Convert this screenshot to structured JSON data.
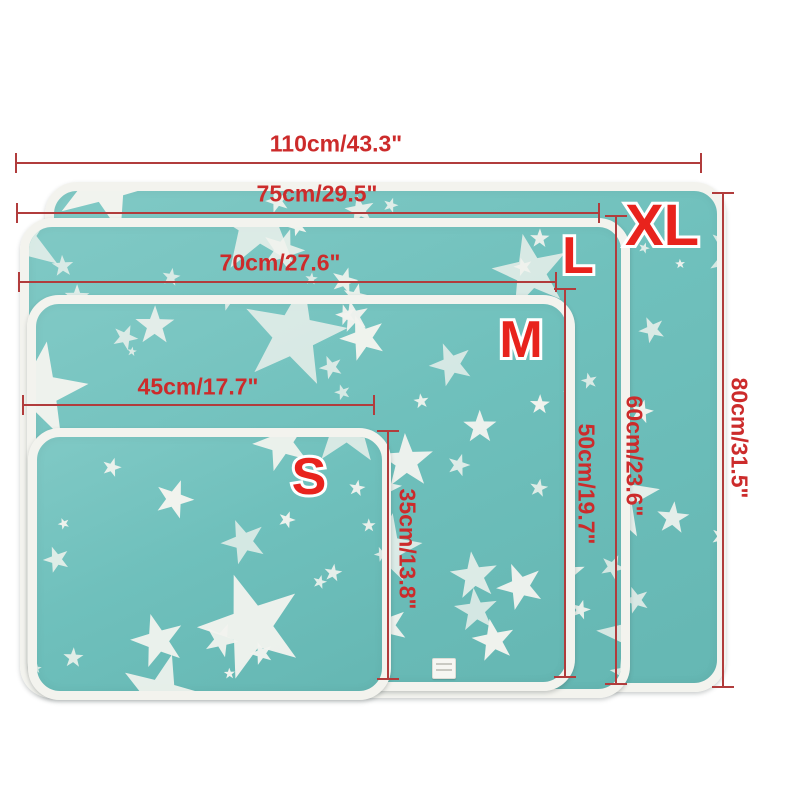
{
  "diagram": {
    "kind": "product-size-chart",
    "colors": {
      "background": "#ffffff",
      "mat_teal": "#6fc0bc",
      "star_white": "#f1f3ee",
      "border_white": "#f3f3ee",
      "dimension_line": "#b13c3c",
      "dimension_text": "#cc2b2b",
      "size_letter": "#e8231d"
    },
    "sizes": [
      {
        "label": "S",
        "width": "45cm/17.7\"",
        "height": "35cm/13.8\""
      },
      {
        "label": "M",
        "width": "70cm/27.6\"",
        "height": "50cm/19.7\""
      },
      {
        "label": "L",
        "width": "75cm/29.5\"",
        "height": "60cm/23.6\""
      },
      {
        "label": "XL",
        "width": "110cm/43.3\"",
        "height": "80cm/31.5\""
      }
    ]
  }
}
